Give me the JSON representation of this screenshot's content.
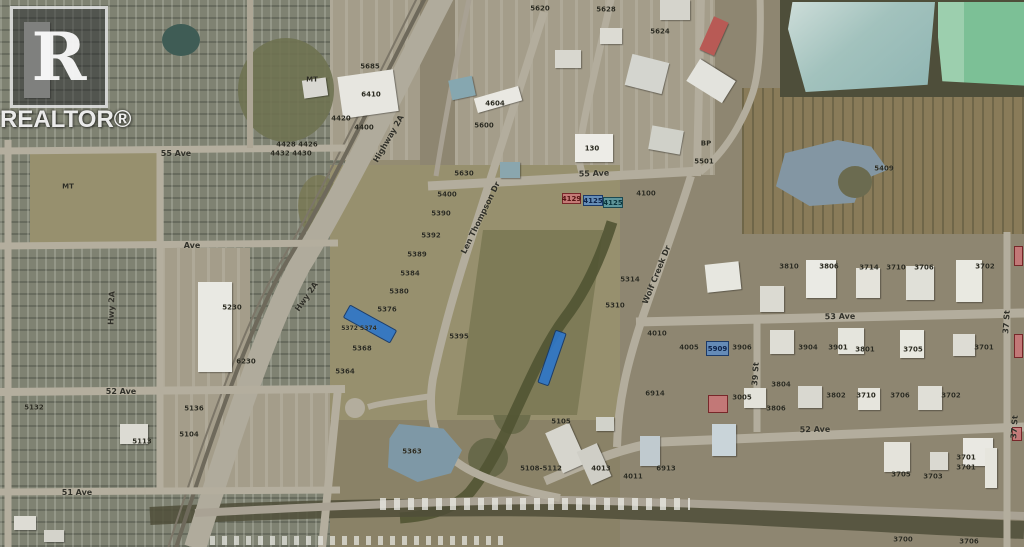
{
  "watermark": {
    "letter": "R",
    "brand": "REALTOR®"
  },
  "colors": {
    "highlight_blue": "#2f77c8",
    "badge_red": "#ca7678",
    "badge_blue": "#608cc0",
    "badge_teal": "#5896a0"
  },
  "map": {
    "street_labels": [
      {
        "text": "55 Ave",
        "x": 594,
        "y": 174,
        "rot": -2
      },
      {
        "text": "55 Ave",
        "x": 176,
        "y": 154,
        "rot": 0
      },
      {
        "text": "53 Ave",
        "x": 840,
        "y": 317,
        "rot": -1
      },
      {
        "text": "52 Ave",
        "x": 815,
        "y": 430,
        "rot": -1
      },
      {
        "text": "52 Ave",
        "x": 121,
        "y": 392,
        "rot": 0
      },
      {
        "text": "51 Ave",
        "x": 77,
        "y": 493,
        "rot": 0
      },
      {
        "text": "Ave",
        "x": 192,
        "y": 246,
        "rot": 0
      },
      {
        "text": "39 St",
        "x": 756,
        "y": 374,
        "rot": -86
      },
      {
        "text": "37 St",
        "x": 1007,
        "y": 322,
        "rot": -86
      },
      {
        "text": "37 St",
        "x": 1015,
        "y": 427,
        "rot": -86
      },
      {
        "text": "Len Thompson Dr",
        "x": 481,
        "y": 218,
        "rot": -64
      },
      {
        "text": "Wolf Creek Dr",
        "x": 657,
        "y": 275,
        "rot": -68
      },
      {
        "text": "Hwy 2A",
        "x": 307,
        "y": 297,
        "rot": -55
      },
      {
        "text": "Hwy 2A",
        "x": 112,
        "y": 308,
        "rot": -88
      },
      {
        "text": "Highway 2A",
        "x": 389,
        "y": 139,
        "rot": -60
      }
    ],
    "lot_labels": [
      {
        "text": "5620",
        "x": 540,
        "y": 9
      },
      {
        "text": "5628",
        "x": 606,
        "y": 10
      },
      {
        "text": "5624",
        "x": 660,
        "y": 32
      },
      {
        "text": "5685",
        "x": 370,
        "y": 67
      },
      {
        "text": "MT",
        "x": 312,
        "y": 80
      },
      {
        "text": "6410",
        "x": 371,
        "y": 95
      },
      {
        "text": "4604",
        "x": 495,
        "y": 104
      },
      {
        "text": "4420",
        "x": 341,
        "y": 119
      },
      {
        "text": "5600",
        "x": 484,
        "y": 126
      },
      {
        "text": "4400",
        "x": 364,
        "y": 128
      },
      {
        "text": "BP",
        "x": 706,
        "y": 144
      },
      {
        "text": "4428 4426",
        "x": 297,
        "y": 145
      },
      {
        "text": "130",
        "x": 592,
        "y": 149
      },
      {
        "text": "4432 4430",
        "x": 291,
        "y": 154
      },
      {
        "text": "5501",
        "x": 704,
        "y": 162
      },
      {
        "text": "5409",
        "x": 884,
        "y": 169
      },
      {
        "text": "5630",
        "x": 464,
        "y": 174
      },
      {
        "text": "MT",
        "x": 68,
        "y": 187
      },
      {
        "text": "4100",
        "x": 646,
        "y": 194
      },
      {
        "text": "5400",
        "x": 447,
        "y": 195
      },
      {
        "text": "5390",
        "x": 441,
        "y": 214
      },
      {
        "text": "5392",
        "x": 431,
        "y": 236
      },
      {
        "text": "5389",
        "x": 417,
        "y": 255
      },
      {
        "text": "3810",
        "x": 789,
        "y": 267
      },
      {
        "text": "3806",
        "x": 829,
        "y": 267
      },
      {
        "text": "3714",
        "x": 869,
        "y": 268
      },
      {
        "text": "3710",
        "x": 896,
        "y": 268
      },
      {
        "text": "3706",
        "x": 924,
        "y": 268
      },
      {
        "text": "3702",
        "x": 985,
        "y": 267
      },
      {
        "text": "5384",
        "x": 410,
        "y": 274
      },
      {
        "text": "5314",
        "x": 630,
        "y": 280
      },
      {
        "text": "5380",
        "x": 399,
        "y": 292
      },
      {
        "text": "5310",
        "x": 615,
        "y": 306
      },
      {
        "text": "5230",
        "x": 232,
        "y": 308
      },
      {
        "text": "5376",
        "x": 387,
        "y": 310
      },
      {
        "text": "5372 5374",
        "x": 359,
        "y": 329,
        "size": 6
      },
      {
        "text": "4010",
        "x": 657,
        "y": 334
      },
      {
        "text": "5395",
        "x": 459,
        "y": 337
      },
      {
        "text": "4005",
        "x": 689,
        "y": 348
      },
      {
        "text": "3906",
        "x": 742,
        "y": 348
      },
      {
        "text": "3904",
        "x": 808,
        "y": 348
      },
      {
        "text": "3901",
        "x": 838,
        "y": 348
      },
      {
        "text": "5368",
        "x": 362,
        "y": 349
      },
      {
        "text": "3801",
        "x": 865,
        "y": 350
      },
      {
        "text": "3705",
        "x": 913,
        "y": 350
      },
      {
        "text": "3701",
        "x": 984,
        "y": 348
      },
      {
        "text": "6230",
        "x": 246,
        "y": 362
      },
      {
        "text": "5364",
        "x": 345,
        "y": 372
      },
      {
        "text": "3804",
        "x": 781,
        "y": 385
      },
      {
        "text": "6914",
        "x": 655,
        "y": 394
      },
      {
        "text": "3802",
        "x": 836,
        "y": 396
      },
      {
        "text": "3710",
        "x": 866,
        "y": 396
      },
      {
        "text": "3706",
        "x": 900,
        "y": 396
      },
      {
        "text": "3702",
        "x": 951,
        "y": 396
      },
      {
        "text": "3005",
        "x": 742,
        "y": 398
      },
      {
        "text": "5132",
        "x": 34,
        "y": 408
      },
      {
        "text": "5136",
        "x": 194,
        "y": 409
      },
      {
        "text": "3806",
        "x": 776,
        "y": 409
      },
      {
        "text": "5105",
        "x": 561,
        "y": 422
      },
      {
        "text": "5104",
        "x": 189,
        "y": 435
      },
      {
        "text": "5113",
        "x": 142,
        "y": 442
      },
      {
        "text": "5363",
        "x": 412,
        "y": 452
      },
      {
        "text": "3701",
        "x": 966,
        "y": 458
      },
      {
        "text": "3701",
        "x": 966,
        "y": 468
      },
      {
        "text": "5108-5112",
        "x": 541,
        "y": 469
      },
      {
        "text": "4013",
        "x": 601,
        "y": 469
      },
      {
        "text": "6913",
        "x": 666,
        "y": 469
      },
      {
        "text": "3705",
        "x": 901,
        "y": 475
      },
      {
        "text": "4011",
        "x": 633,
        "y": 477
      },
      {
        "text": "3703",
        "x": 933,
        "y": 477
      },
      {
        "text": "3700",
        "x": 903,
        "y": 540
      },
      {
        "text": "3706",
        "x": 969,
        "y": 542
      }
    ],
    "parcels": [
      {
        "label": "4129",
        "x": 562,
        "y": 193,
        "w": 19,
        "h": 11,
        "type": "red"
      },
      {
        "label": "4125",
        "x": 583,
        "y": 195,
        "w": 20,
        "h": 11,
        "type": "blue"
      },
      {
        "label": "4125",
        "x": 603,
        "y": 197,
        "w": 20,
        "h": 11,
        "type": "teal"
      },
      {
        "label": "5909",
        "x": 706,
        "y": 341,
        "w": 23,
        "h": 15,
        "type": "blue"
      },
      {
        "label": "",
        "x": 708,
        "y": 395,
        "w": 20,
        "h": 18,
        "type": "red"
      },
      {
        "label": "",
        "x": 1014,
        "y": 246,
        "w": 9,
        "h": 20,
        "type": "red"
      },
      {
        "label": "",
        "x": 1014,
        "y": 334,
        "w": 9,
        "h": 24,
        "type": "red"
      },
      {
        "label": "",
        "x": 1012,
        "y": 427,
        "w": 10,
        "h": 14,
        "type": "red"
      }
    ],
    "highlight_strips": [
      {
        "x": 370,
        "y": 324,
        "len": 52,
        "wid": 13,
        "rot": 29
      },
      {
        "x": 552,
        "y": 358,
        "len": 54,
        "wid": 10,
        "rot": 109
      }
    ]
  }
}
